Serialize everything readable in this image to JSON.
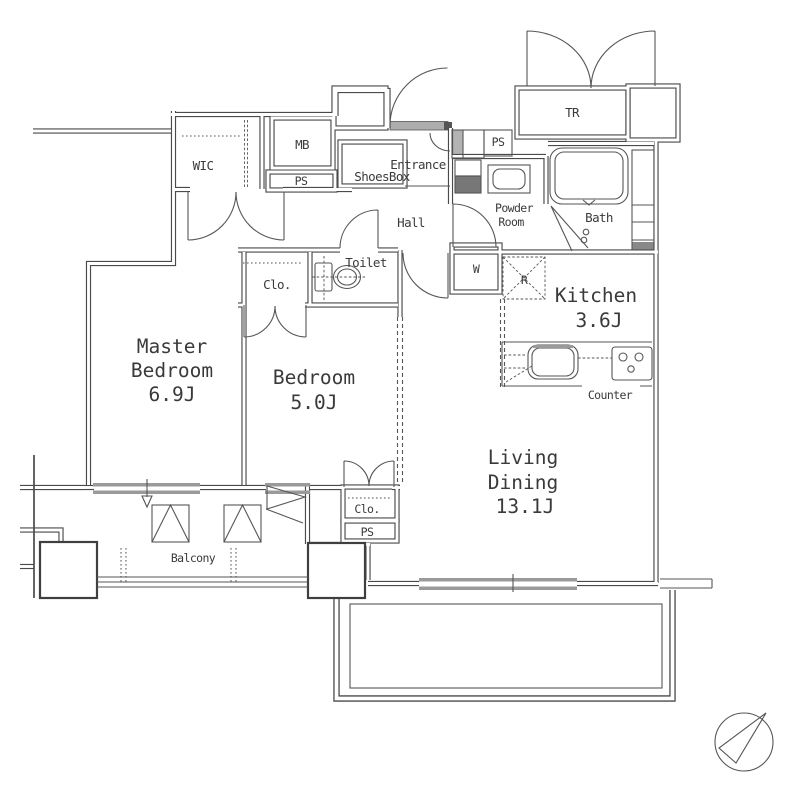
{
  "plan": {
    "rooms": [
      {
        "id": "master-bedroom",
        "lines": [
          "Master",
          "Bedroom"
        ],
        "size": "6.9J"
      },
      {
        "id": "bedroom",
        "lines": [
          "Bedroom"
        ],
        "size": "5.0J"
      },
      {
        "id": "living-dining",
        "lines": [
          "Living",
          "Dining"
        ],
        "size": "13.1J"
      },
      {
        "id": "kitchen",
        "lines": [
          "Kitchen"
        ],
        "size": "3.6J"
      }
    ],
    "labels": {
      "wic": "WIC",
      "mb": "MB",
      "ps_meter": "PS",
      "ps_entrance": "PS",
      "ps_lower": "PS",
      "tr": "TR",
      "entrance": "Entrance",
      "shoes_box": "ShoesBox",
      "hall": "Hall",
      "powder_line1": "Powder",
      "powder_line2": "Room",
      "bath": "Bath",
      "toilet": "Toilet",
      "clo_upper": "Clo.",
      "clo_lower": "Clo.",
      "washer": "W",
      "fridge": "R",
      "counter": "Counter",
      "balcony": "Balcony"
    },
    "colors": {
      "line": "#4a4a4a",
      "text": "#3a3a3a",
      "window": "#9a9a9a",
      "hatch": "#b3b3b3",
      "dark": "#777777"
    }
  }
}
